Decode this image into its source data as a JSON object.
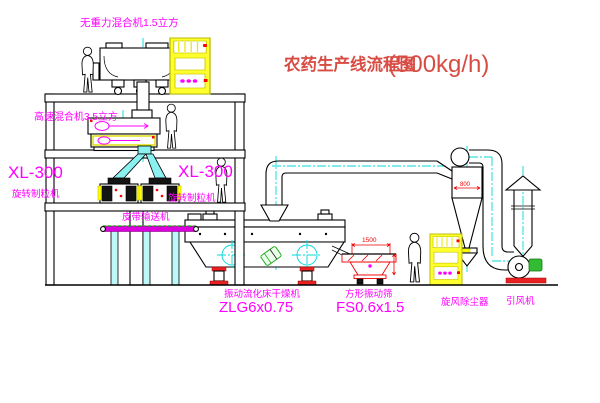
{
  "title": {
    "text": "农药生产线流程图",
    "capacity": "(500kg/h)"
  },
  "labels": {
    "gravity_mixer": "无重力混合机1.5立方",
    "high_speed_mixer": "高速混合机3.5立方",
    "xl300_left": {
      "model": "XL-300",
      "name": "旋转制粒机"
    },
    "xl300_mid": {
      "model": "XL-300",
      "name": "旋转制粒机"
    },
    "belt_conveyor": "皮带输送机",
    "dryer": {
      "name": "振动流化床干燥机",
      "model": "ZLG6x0.75"
    },
    "sieve": {
      "name": "方形振动筛",
      "model": "FS0.6x1.5"
    },
    "cyclone": "旋风除尘器",
    "fan": "引风机"
  },
  "dimensions": {
    "sieve_width": "1500",
    "cyclone_diameter": "800"
  },
  "colors": {
    "label_magenta": "#ff00ff",
    "title_red": "#d84c44",
    "dim_red": "#f00000",
    "centerline_cyan": "#00d9d9",
    "cabinet_yellow": "#ffff00",
    "motor_green": "#33bb33",
    "line_black": "#000000"
  }
}
